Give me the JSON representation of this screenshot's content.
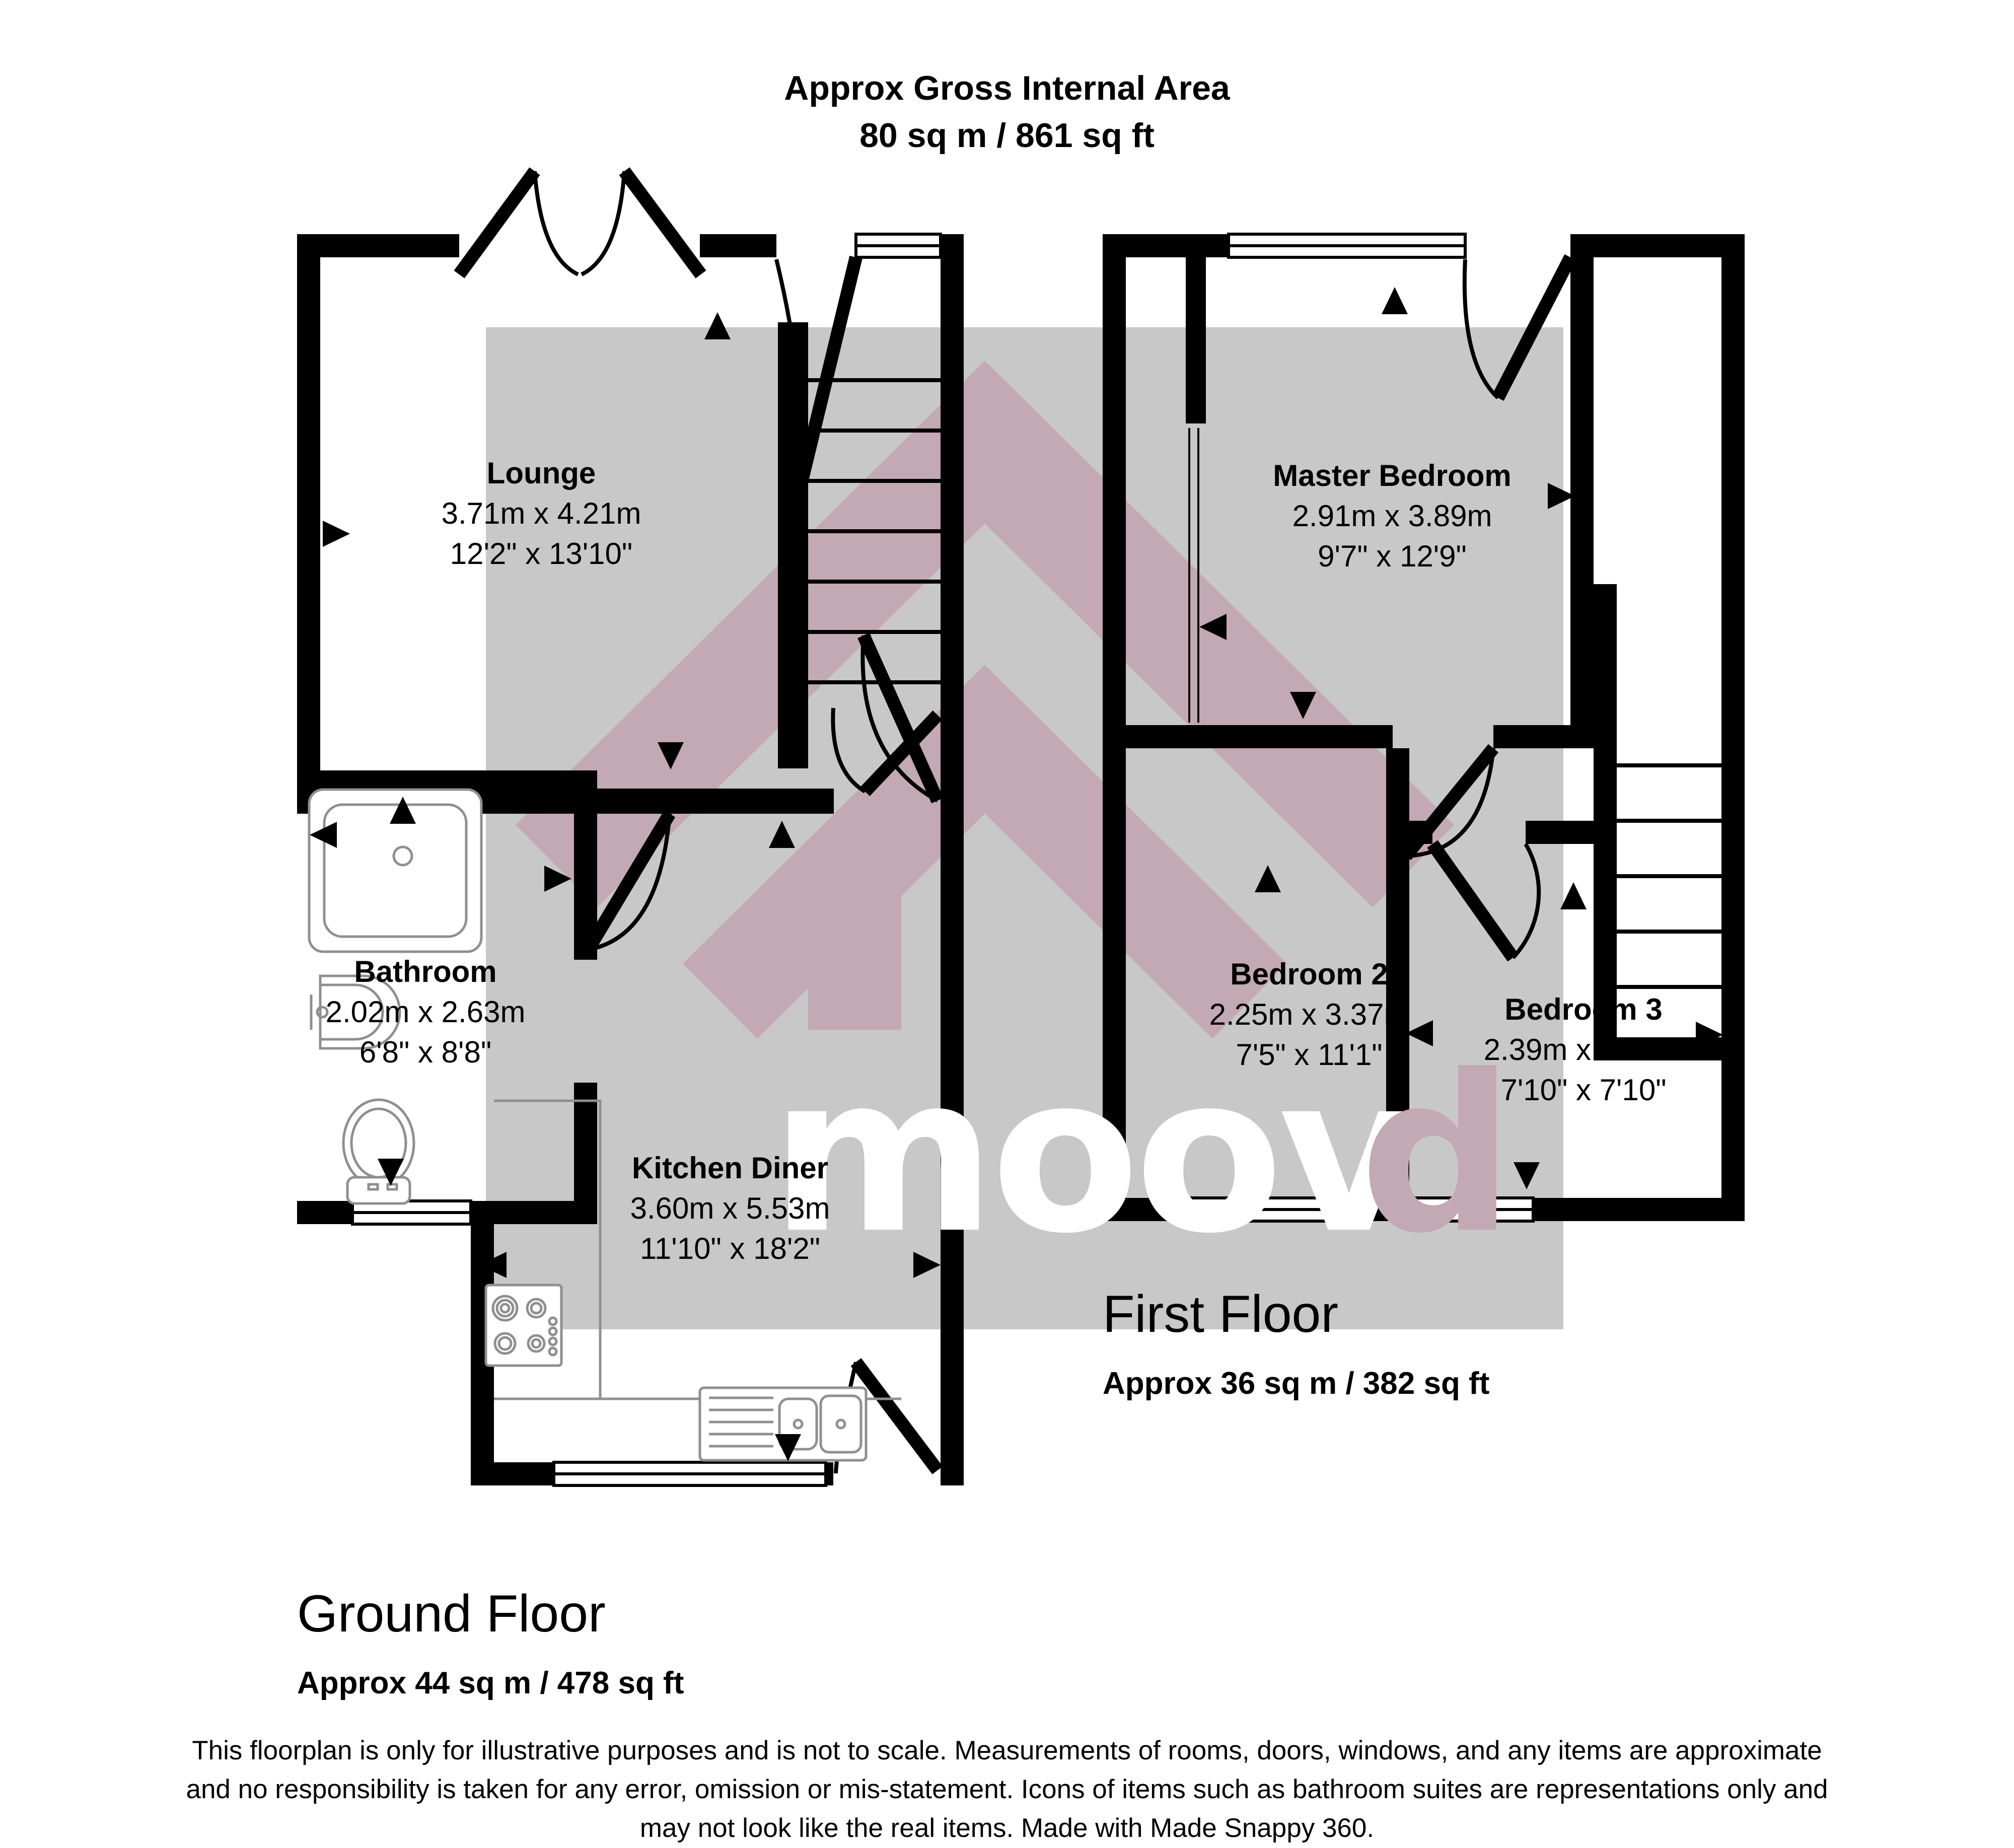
{
  "header": {
    "line1": "Approx Gross Internal Area",
    "line2": "80 sq m / 861 sq ft"
  },
  "rooms": [
    {
      "name": "Lounge",
      "metric": "3.71m x 4.21m",
      "imperial": "12'2\" x 13'10\""
    },
    {
      "name": "Bathroom",
      "metric": "2.02m x 2.63m",
      "imperial": "6'8\" x 8'8\""
    },
    {
      "name": "Kitchen Diner",
      "metric": "3.60m x 5.53m",
      "imperial": "11'10\" x 18'2\""
    },
    {
      "name": "Master Bedroom",
      "metric": "2.91m x 3.89m",
      "imperial": "9'7\" x 12'9\""
    },
    {
      "name": "Bedroom 2",
      "metric": "2.25m x 3.37m",
      "imperial": "7'5\" x 11'1\""
    },
    {
      "name": "Bedroom 3",
      "metric": "2.39m x 2.38m",
      "imperial": "7'10\" x 7'10\""
    }
  ],
  "floors": [
    {
      "name": "Ground Floor",
      "area": "Approx 44 sq m / 478 sq ft"
    },
    {
      "name": "First Floor",
      "area": "Approx 36 sq m / 382 sq ft"
    }
  ],
  "watermark": {
    "white": "moov",
    "pink": "d"
  },
  "disclaimer": {
    "line1": "This floorplan is only for illustrative purposes and is not to scale. Measurements of rooms, doors, windows, and any items are approximate",
    "line2": "and no responsibility is taken for any error, omission or mis-statement. Icons of items such as bathroom suites are representations only and",
    "line3": "may not look like the real items. Made with Made Snappy 360."
  },
  "colors": {
    "wall": "#000000",
    "watermark_gray": "#c8c8c8",
    "watermark_pink_on_gray": "#c3a9b3",
    "watermark_pink": "#f9d7e4",
    "fixture_stroke": "#8f8f8f"
  }
}
